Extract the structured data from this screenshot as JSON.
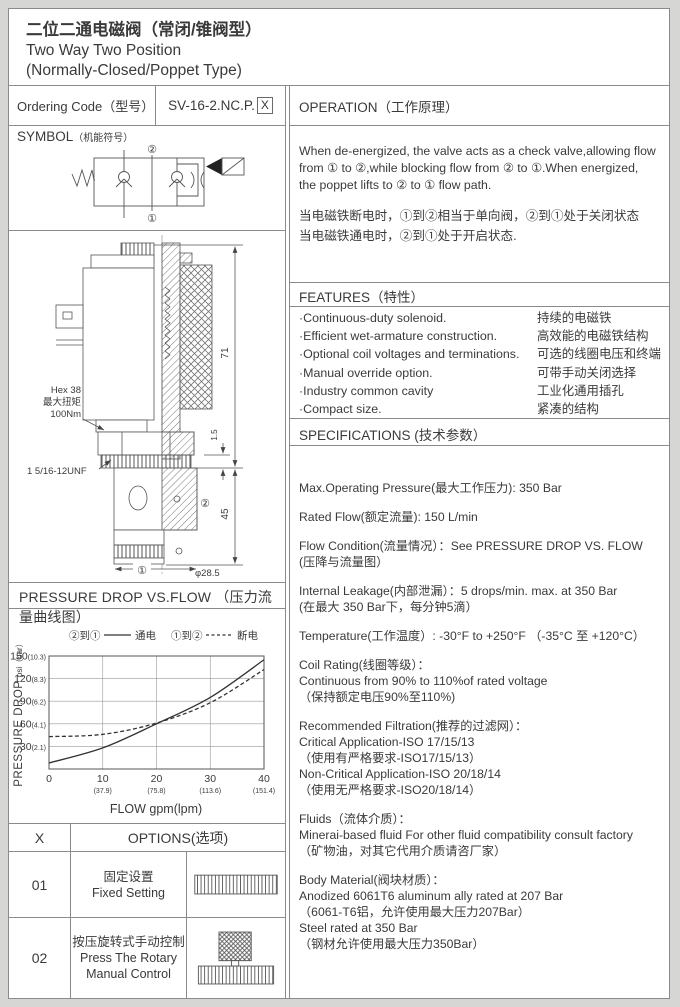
{
  "title": {
    "line1_zh": "二位二通电磁阀（常闭/锥阀型）",
    "line2_en": "Two Way Two Position",
    "line3_en": "(Normally-Closed/Poppet Type)"
  },
  "ordering": {
    "label": "Ordering Code（型号）",
    "code": "SV-16-2.NC.P.",
    "code_box": "X"
  },
  "symbol": {
    "header_main": "SYMBOL",
    "header_sub": "（机能符号）",
    "port_top": "②",
    "port_bottom": "①"
  },
  "operation": {
    "header": "OPERATION（工作原理）",
    "en_lines": [
      "When de-energized, the valve acts as a check valve,allowing flow",
      "from ① to ②,while blocking flow from ② to ①.When energized,",
      "the poppet lifts to ② to ① flow path."
    ],
    "zh_lines": [
      "当电磁铁断电时，①到②相当于单向阀，②到①处于关闭状态",
      "当电磁铁通电时，②到①处于开启状态."
    ]
  },
  "features": {
    "header": "FEATURES（特性）",
    "items": [
      {
        "en": "·Continuous-duty  solenoid.",
        "zh": "持续的电磁铁"
      },
      {
        "en": "·Efficient wet-armature construction.",
        "zh": "高效能的电磁铁结构"
      },
      {
        "en": "·Optional coil voltages and terminations.",
        "zh": "可选的线圈电压和终端"
      },
      {
        "en": "·Manual override option.",
        "zh": "可带手动关闭选择"
      },
      {
        "en": "·Industry common cavity",
        "zh": "工业化通用插孔"
      },
      {
        "en": "·Compact size.",
        "zh": "紧凑的结构"
      }
    ]
  },
  "specifications": {
    "header": "SPECIFICATIONS (技术参数）",
    "paragraphs": [
      [
        "Max.Operating Pressure(最大工作压力): 350 Bar"
      ],
      [
        "Rated Flow(额定流量): 150 L/min"
      ],
      [
        "Flow Condition(流量情况）：See PRESSURE DROP VS. FLOW",
        "(压降与流量图）"
      ],
      [
        "Internal Leakage(内部泄漏）：5 drops/min. max. at 350 Bar",
        "(在最大 350 Bar下，每分钟5滴）"
      ],
      [
        "Temperature(工作温度）: -30°F to +250°F （-35°C 至 +120°C）"
      ],
      [
        "Coil Rating(线圈等级）：",
        "Continuous from 90% to 110%of rated voltage",
        "（保持额定电压90%至110%)"
      ],
      [
        "Recommended Filtration(推荐的过滤网）：",
        "Critical Application-ISO 17/15/13",
        "（使用有严格要求-ISO17/15/13）",
        "Non-Critical Application-ISO 20/18/14",
        "（使用无严格要求-ISO20/18/14）"
      ],
      [
        "Fluids（流体介质）：",
        "Minerai-based fluid For other fluid compatibility consult factory",
        "（矿物油，对其它代用介质请咨厂家）"
      ],
      [
        "Body Material(阀块材质）：",
        "Anodized 6061T6 aluminum ally rated at 207 Bar",
        "（6061-T6铝，允许使用最大压力207Bar）",
        "Steel rated at 350 Bar",
        "（钢材允许使用最大压力350Bar）"
      ]
    ]
  },
  "drawing": {
    "hex_line1": "Hex 38",
    "hex_line2": "最大扭矩",
    "hex_line3": "100Nm",
    "thread_label": "1 5/16-12UNF",
    "dim_total_height": "71",
    "dim_cartridge_length": "45",
    "dim_gap": "1.5",
    "dia_label": "φ28.5",
    "port1": "①",
    "port2": "②"
  },
  "pressure_section": {
    "header": "PRESSURE DROP VS.FLOW （压力流量曲线图）"
  },
  "chart_data": {
    "type": "line",
    "title": "",
    "xlabel": "FLOW gpm(lpm)",
    "ylabel_main": "PRESSURE DROP",
    "ylabel_unit": "psi（bar）",
    "xlim": [
      0,
      40
    ],
    "ylim": [
      0,
      150
    ],
    "grid": true,
    "legend_position": "top",
    "x_ticks": [
      {
        "gpm": "0",
        "lpm": ""
      },
      {
        "gpm": "10",
        "lpm": "(37.9)"
      },
      {
        "gpm": "20",
        "lpm": "(75.8)"
      },
      {
        "gpm": "30",
        "lpm": "(113.6)"
      },
      {
        "gpm": "40",
        "lpm": "(151.4)"
      }
    ],
    "y_ticks": [
      {
        "psi": "30",
        "bar": "(2.1)"
      },
      {
        "psi": "60",
        "bar": "(4.1)"
      },
      {
        "psi": "90",
        "bar": "(6.2)"
      },
      {
        "psi": "120",
        "bar": "(8.3)"
      },
      {
        "psi": "150",
        "bar": "(10.3)"
      }
    ],
    "legend": [
      {
        "ports": "②到①",
        "label": "通电",
        "style": "solid"
      },
      {
        "ports": "①到②",
        "label": "断电",
        "style": "dashed"
      }
    ],
    "series": [
      {
        "name": "通电 (energized ②→①)",
        "style": "solid",
        "x": [
          0,
          10,
          20,
          30,
          40
        ],
        "y": [
          8,
          28,
          60,
          95,
          145
        ]
      },
      {
        "name": "断电 (de-energized ①→②)",
        "style": "dashed",
        "x": [
          0,
          10,
          20,
          30,
          40
        ],
        "y": [
          43,
          46,
          61,
          88,
          132
        ]
      }
    ]
  },
  "options_table": {
    "col_x": "X",
    "header": "OPTIONS(选项)",
    "rows": [
      {
        "code": "01",
        "zh": "固定设置",
        "en": "Fixed Setting",
        "en2": "",
        "image": "fixed-setting-cap"
      },
      {
        "code": "02",
        "zh": "按压旋转式手动控制",
        "en": "Press The Rotary",
        "en2": "Manual Control",
        "image": "rotary-manual-knob"
      }
    ]
  }
}
